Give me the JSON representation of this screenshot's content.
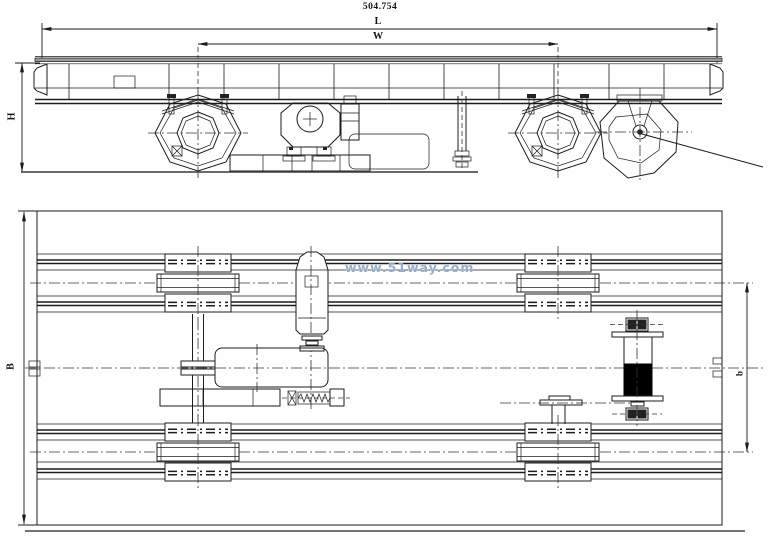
{
  "drawing": {
    "part_number": "504.754",
    "dim_length_label": "L",
    "dim_width_label": "W",
    "dim_height_label": "H",
    "dim_breadth_label": "B",
    "dim_gauge_label": "b",
    "watermark": "www.51way.com",
    "colors": {
      "line": "#1c1c1c",
      "girder_band": "#9b9b9b",
      "drum_fill": "#000000",
      "watermark": "#7c98be",
      "background": "#fefefe"
    }
  }
}
